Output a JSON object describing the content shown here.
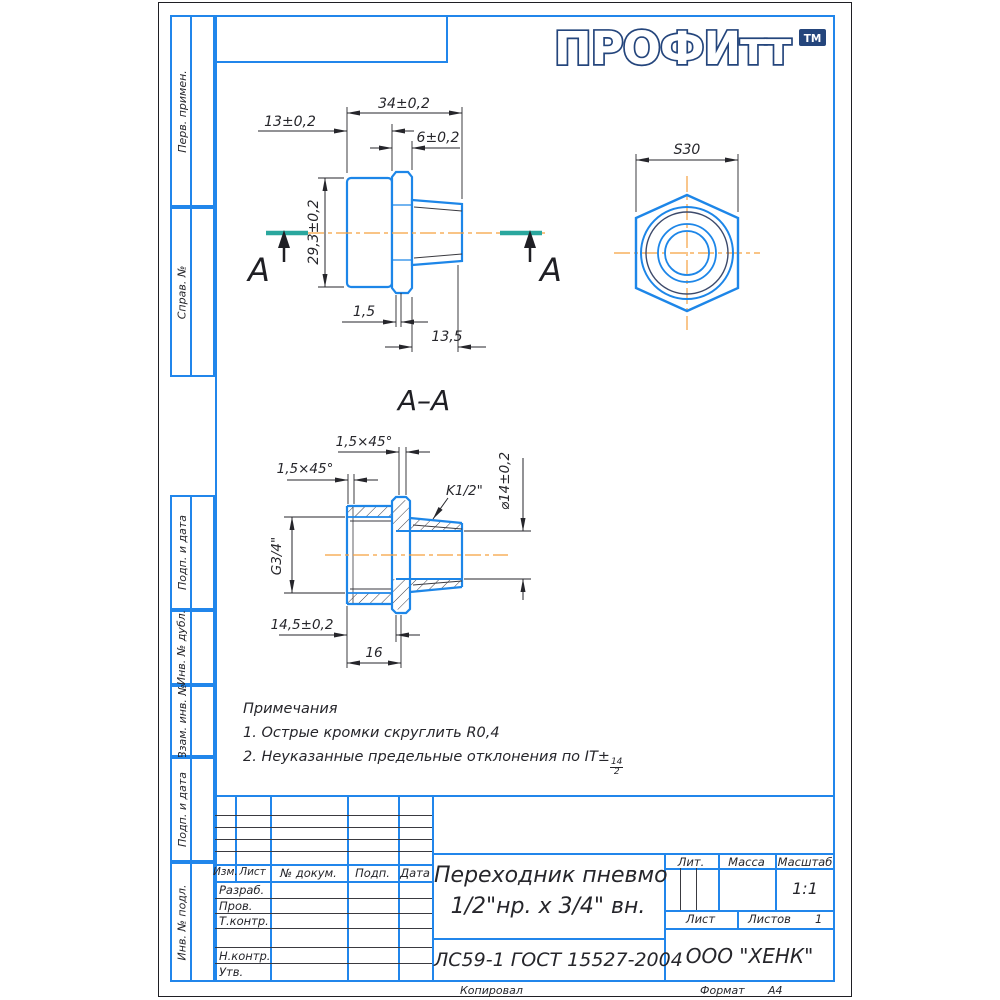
{
  "colors": {
    "frame_blue": "#2186eb",
    "draw_blue": "#1d86e8",
    "centerline_orange": "#f5a03f",
    "section_teal": "#2aa79e",
    "dim_dark": "#26262b",
    "logo_navy": "#24457c",
    "thread_dark": "#3d4a6b"
  },
  "logo": {
    "text": "ПРОФИтт",
    "tm": "ТМ"
  },
  "sidebar": {
    "cells": [
      {
        "label": "Перв. примен."
      },
      {
        "label": "Справ. №"
      },
      {
        "label": "Подп. и дата"
      },
      {
        "label": "Инв. № дубл."
      },
      {
        "label": "Взам. инв. №"
      },
      {
        "label": "Подп. и дата"
      },
      {
        "label": "Инв. № подл."
      }
    ]
  },
  "views": {
    "front": {
      "dim_total": "34±0,2",
      "dim_body": "13±0,2",
      "dim_hex": "6±0,2",
      "dim_od": "29,3±0,2",
      "dim_chamfer": "1,5",
      "dim_taper": "13,5",
      "section_letter_left": "A",
      "section_letter_right": "A"
    },
    "hex_view": {
      "dim_wrench": "S30"
    },
    "section": {
      "title": "A–A",
      "chamfer_top": "1,5×45°",
      "chamfer_left": "1,5×45°",
      "thread_male": "K1/2\"",
      "bore": "⌀14±0,2",
      "thread_female": "G3/4\"",
      "dim_depth": "14,5±0,2",
      "dim_len": "16"
    }
  },
  "notes": {
    "title": "Примечания",
    "item1": "1. Острые кромки скруглить R0,4",
    "item2_text": "2. Неуказанные предельные отклонения по IT±",
    "item2_frac_num": "14",
    "item2_frac_den": "2"
  },
  "title_block": {
    "rev_header": {
      "izm": "Изм.",
      "list": "Лист",
      "doc": "№ докум.",
      "podp": "Подп.",
      "data": "Дата"
    },
    "staff": {
      "razrab": "Разраб.",
      "prov": "Пров.",
      "tkontr": "Т.контр.",
      "nkontr": "Н.контр.",
      "utv": "Утв."
    },
    "title_line1": "Переходник пневмо",
    "title_line2": "1/2\"нр. х 3/4\" вн.",
    "material": "ЛС59-1 ГОСТ 15527-2004",
    "lit_label": "Лит.",
    "mass_label": "Масса",
    "scale_label": "Масштаб",
    "scale_value": "1:1",
    "sheet_label": "Лист",
    "sheets_label": "Листов",
    "sheets_value": "1",
    "company": "ООО \"ХЕНК\""
  },
  "footer": {
    "copied": "Копировал",
    "format_label": "Формат",
    "format_value": "А4"
  }
}
